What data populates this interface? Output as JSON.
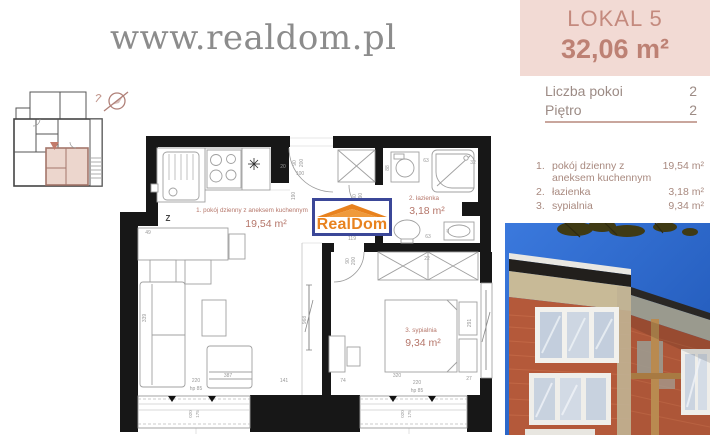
{
  "watermark": "www.realdom.pl",
  "header": {
    "title": "LOKAL 5",
    "area": "32,06 m²"
  },
  "info": {
    "rows": [
      {
        "label": "Liczba pokoi",
        "value": "2"
      },
      {
        "label": "Piętro",
        "value": "2"
      }
    ]
  },
  "room_list": {
    "items": [
      {
        "num": "1.",
        "name": "pokój dzienny z aneksem kuchennym",
        "area": "19,54 m²"
      },
      {
        "num": "2.",
        "name": "łazienka",
        "area": "3,18 m²"
      },
      {
        "num": "3.",
        "name": "sypialnia",
        "area": "9,34 m²"
      }
    ]
  },
  "logo": {
    "text": "RealDom"
  },
  "plan": {
    "rooms": [
      {
        "label": "1. pokój dzienny z aneksem kuchennym",
        "area": "19,54 m²"
      },
      {
        "label": "2. łazienka",
        "area": "3,18 m²"
      },
      {
        "label": "3. sypialnia",
        "area": "9,34 m²"
      }
    ],
    "dims": {
      "d20": "20",
      "d49": "49",
      "d90a": "90",
      "d200a": "200",
      "d100": "100",
      "d190a": "190",
      "d80a": "80",
      "d190b": "190",
      "d90b": "90",
      "d200b": "200",
      "d119": "119",
      "d88": "88",
      "d63a": "63",
      "d32": "32",
      "d63b": "63",
      "d40": "40",
      "d22": "22",
      "d291": "291",
      "d339": "339",
      "d387": "387",
      "d968": "968",
      "d220a": "220",
      "hp85a": "hp 85",
      "d141": "141",
      "d74": "74",
      "d320": "320",
      "d220b": "220",
      "hp85b": "hp 85",
      "d27": "27",
      "w020a": "020",
      "w175a": "175",
      "w020b": "020",
      "w175b": "175",
      "z": "Z"
    }
  },
  "colors": {
    "header_bg": "#f2dad4",
    "header_text": "#c48a7e",
    "list_text": "#a8897f",
    "divider": "#c9a69d",
    "wall": "#171717",
    "plan_accent": "#b5766a",
    "logo_orange": "#e8821e",
    "logo_blue": "#3b4798",
    "sky": "#2f6ccc",
    "brick": "#b45a3b"
  }
}
